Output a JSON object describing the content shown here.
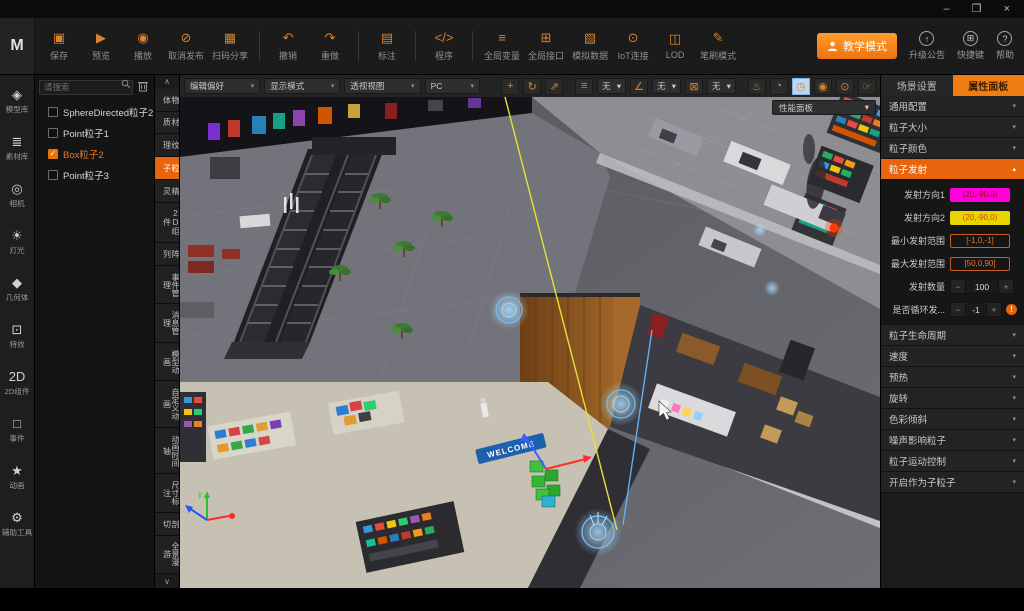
{
  "icons": {
    "minimize": "–",
    "maximize": "❐",
    "close": "×",
    "save": "▣",
    "preview": "▶",
    "play": "◉",
    "cancel_publish": "⊘",
    "scan_share": "▦",
    "undo": "↶",
    "redo": "↷",
    "annotate": "▤",
    "code": "</>",
    "global_vars": "≡",
    "global_api": "⊞",
    "mock_data": "▧",
    "iot": "⊙",
    "lod": "◫",
    "brush": "✎",
    "upgrade": "↑",
    "hotkeys": "⊞",
    "help": "?",
    "model": "◈",
    "assets": "≣",
    "camera": "◎",
    "light": "☀",
    "geometry": "◆",
    "fx": "⊡",
    "comp2d": "2D",
    "events": "□",
    "anim": "★",
    "tools": "⚙",
    "move": "+",
    "rotate": "↻",
    "scale": "⇗",
    "list": "≡",
    "angle": "∠",
    "fit": "⊠",
    "lamp": "♨",
    "pie": "◔",
    "perf": "◷",
    "eye": "◉",
    "target": "⊙",
    "hand": "☞",
    "chev_down": "▾",
    "chev_up": "▴",
    "collapse_up": "∧",
    "collapse_down": "∨",
    "check": "✓",
    "minus": "−",
    "plus": "+"
  },
  "app": {
    "logo": "M"
  },
  "topbar": {
    "buttons": [
      {
        "label": "保存"
      },
      {
        "label": "预览"
      },
      {
        "label": "播放"
      },
      {
        "label": "取消发布"
      },
      {
        "label": "扫码分享"
      },
      {
        "label": "撤销"
      },
      {
        "label": "重做"
      },
      {
        "label": "标注"
      },
      {
        "label": "程序"
      },
      {
        "label": "全局变量"
      },
      {
        "label": "全局接口"
      },
      {
        "label": "模拟数据"
      },
      {
        "label": "IoT连接"
      },
      {
        "label": "LOD"
      },
      {
        "label": "笔刷模式"
      }
    ],
    "teach_mode": "教学模式",
    "right_buttons": [
      {
        "label": "升级公告"
      },
      {
        "label": "快捷键"
      },
      {
        "label": "帮助"
      }
    ]
  },
  "left_toolbar": {
    "items": [
      {
        "label": "模型库"
      },
      {
        "label": "素材库"
      },
      {
        "label": "相机"
      },
      {
        "label": "灯光"
      },
      {
        "label": "几何体"
      },
      {
        "label": "特效"
      },
      {
        "label": "2D组件"
      },
      {
        "label": "事件"
      },
      {
        "label": "动画"
      },
      {
        "label": "辅助工具"
      }
    ]
  },
  "scene_tree": {
    "search_placeholder": "请搜索",
    "items": [
      {
        "label": "SphereDirected粒子2",
        "checked": false
      },
      {
        "label": "Point粒子1",
        "checked": false
      },
      {
        "label": "Box粒子2",
        "checked": true
      },
      {
        "label": "Point粒子3",
        "checked": false
      }
    ]
  },
  "category_tabs": {
    "selected": "粒子",
    "items": [
      "物体",
      "材质",
      "纹理",
      "粒子",
      "精灵",
      "2D组件",
      "阵列",
      "事件管理",
      "消息管理",
      "模型动画",
      "自定义动画",
      "动画时间轴",
      "尺寸标注",
      "剖切",
      "全景漫游"
    ]
  },
  "viewport": {
    "dropdowns": [
      {
        "value": "编辑偏好"
      },
      {
        "value": "显示模式"
      },
      {
        "value": "透视视图"
      },
      {
        "value": "PC"
      }
    ],
    "snap_dropdowns": [
      {
        "value": "无"
      },
      {
        "value": "无"
      },
      {
        "value": "无"
      }
    ],
    "performance_panel": "性能面板",
    "scene": {
      "welcome_sign": "WELCOME",
      "axis_label": "y"
    }
  },
  "right_panel": {
    "tabs": [
      {
        "label": "场景设置",
        "selected": false
      },
      {
        "label": "属性面板",
        "selected": true
      }
    ],
    "sections_top": [
      {
        "title": "通用配置"
      },
      {
        "title": "粒子大小"
      },
      {
        "title": "粒子颜色"
      }
    ],
    "emission": {
      "title": "粒子发射",
      "rows": [
        {
          "label": "发射方向1",
          "value": "(20,-90,0)"
        },
        {
          "label": "发射方向2",
          "value": "(20,-90,0)"
        },
        {
          "label": "最小发射范围",
          "value": "[-1,0,-1]"
        },
        {
          "label": "最大发射范围",
          "value": "[50,0,90]"
        },
        {
          "label": "发射数量",
          "value": "100"
        },
        {
          "label": "是否循环发...",
          "value": "-1"
        }
      ],
      "badge": "!"
    },
    "sections_bottom": [
      {
        "title": "粒子生命周期"
      },
      {
        "title": "速度"
      },
      {
        "title": "预热"
      },
      {
        "title": "旋转"
      },
      {
        "title": "色彩倾斜"
      },
      {
        "title": "噪声影响粒子"
      },
      {
        "title": "粒子运动控制"
      },
      {
        "title": "开启作为子粒子"
      }
    ]
  },
  "colors": {
    "accent": "#ef7d12",
    "selection": "#59b7ff",
    "chip_magenta": "#ff00dd",
    "chip_yellow": "#e8d400",
    "axis_x": "#ff2a2a",
    "axis_y": "#27c427",
    "axis_z": "#2a52ff"
  }
}
